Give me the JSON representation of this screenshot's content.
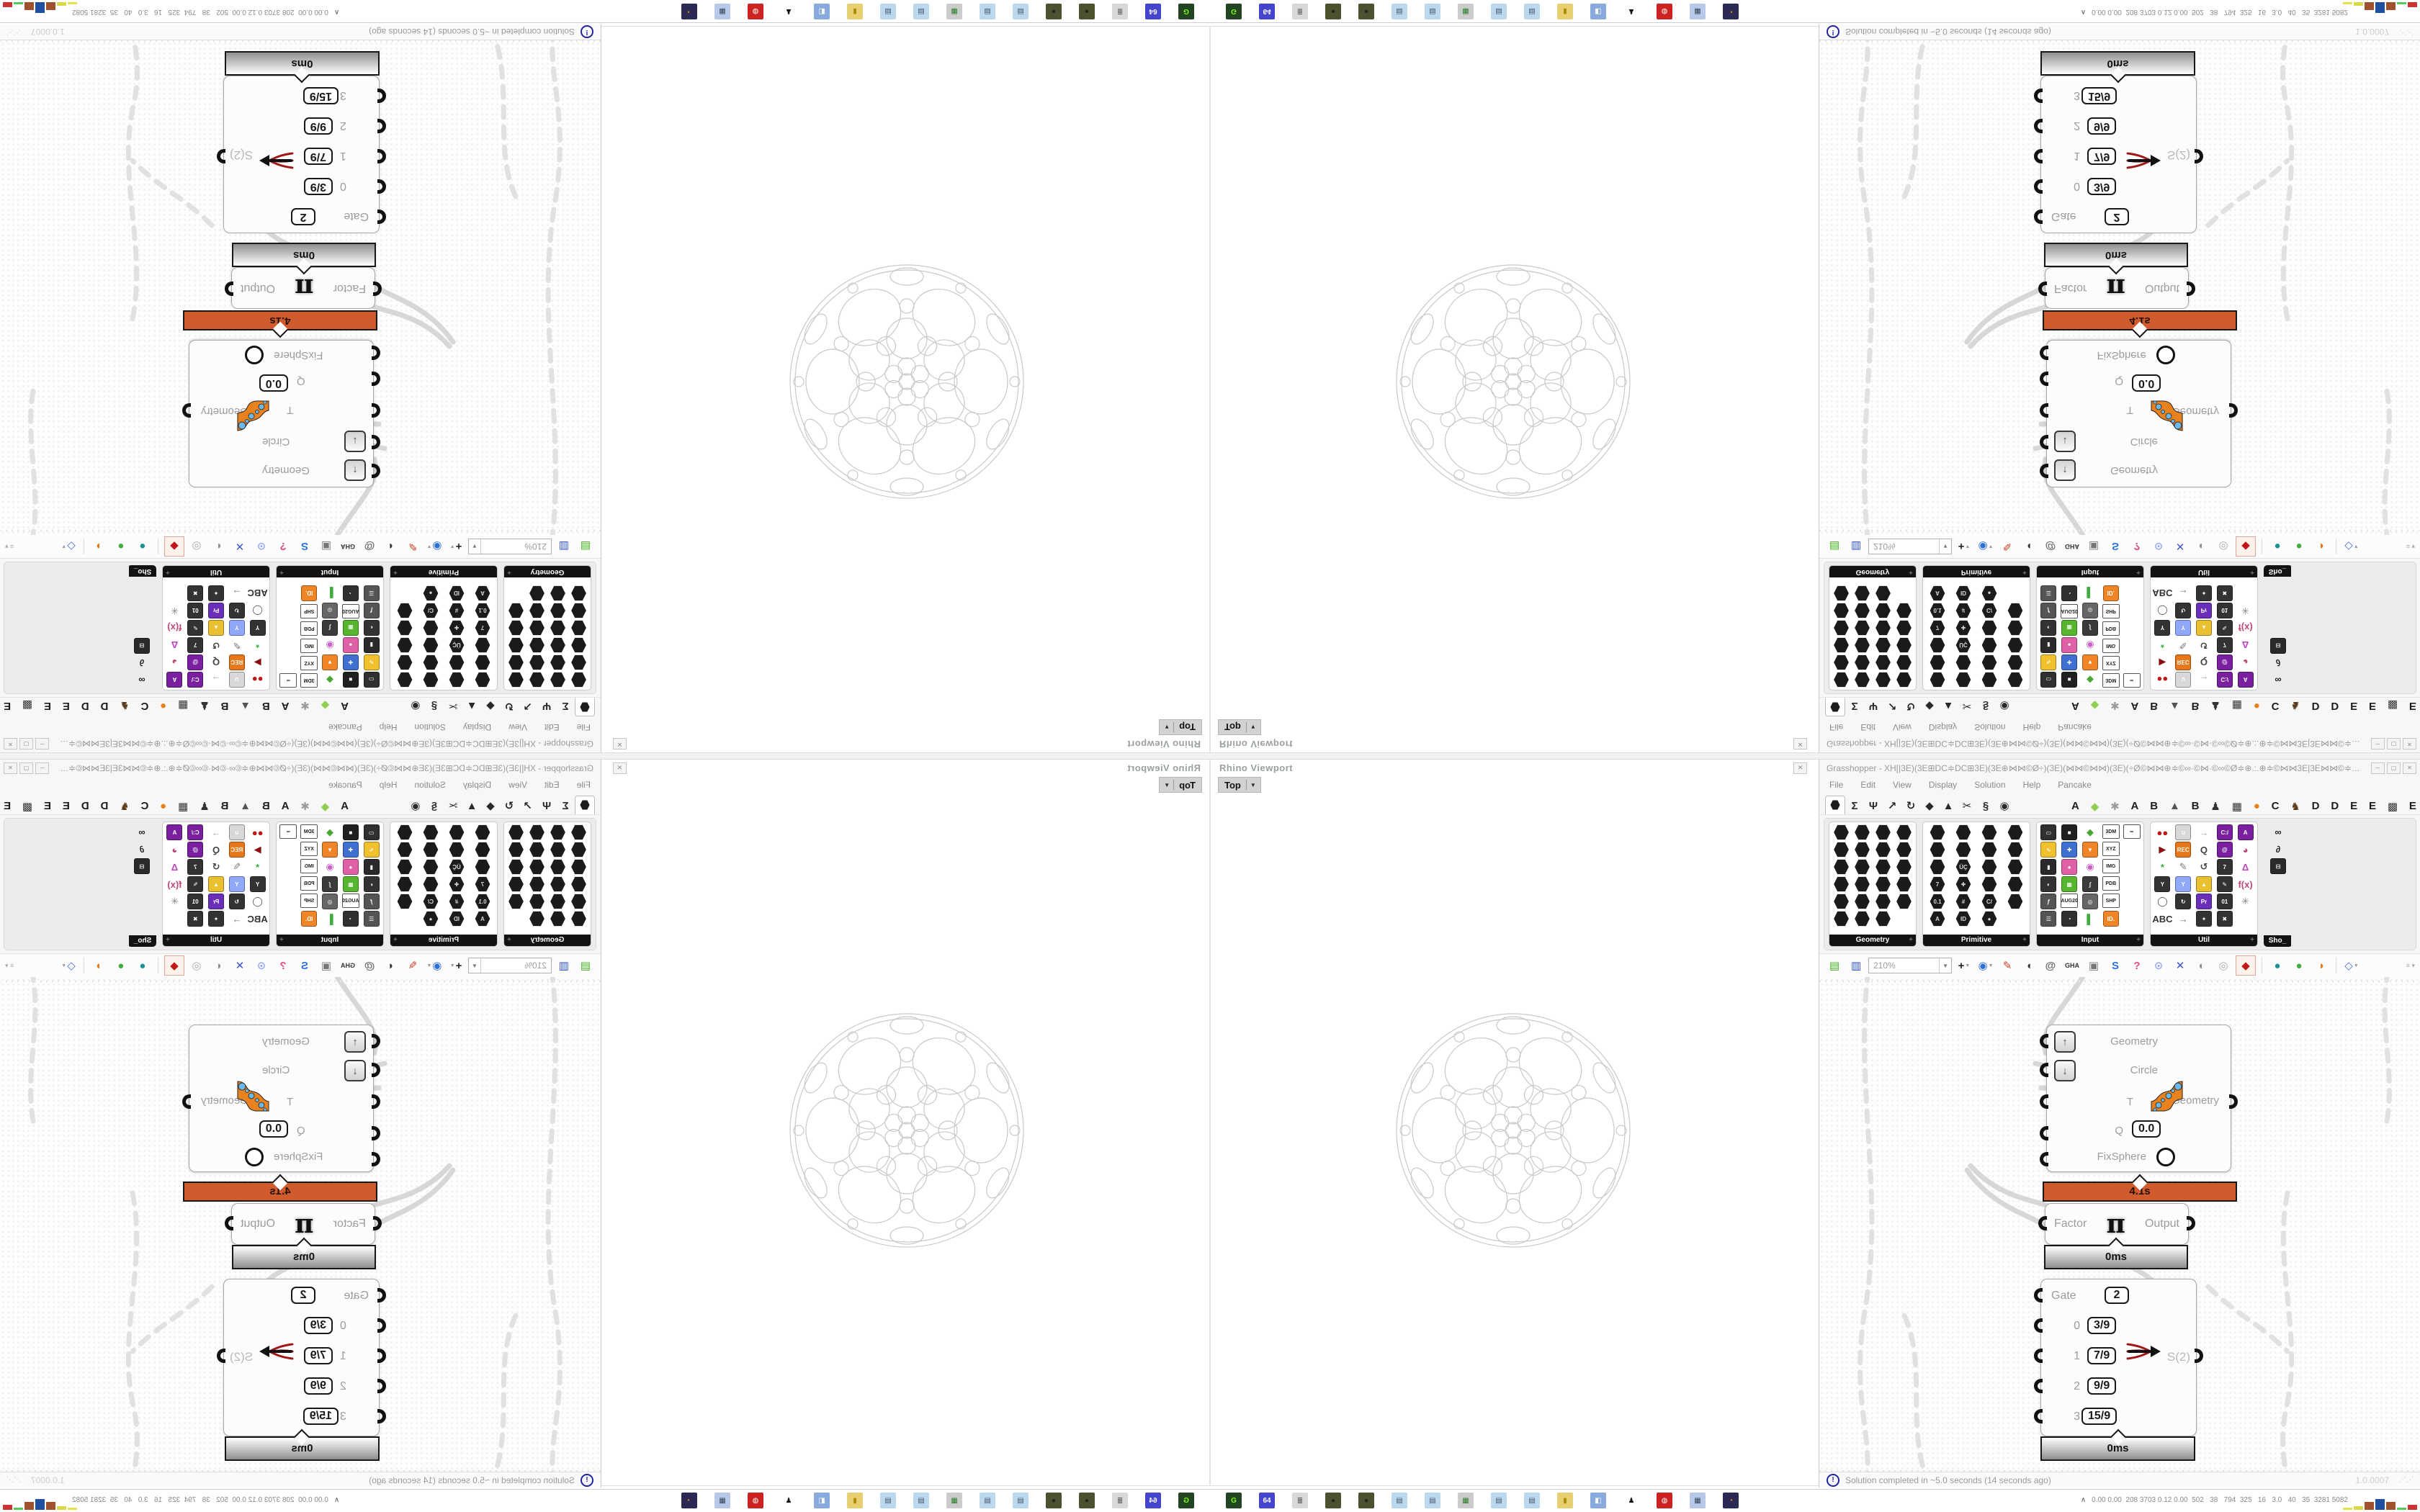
{
  "gh": {
    "title": "Grasshopper - XH[|3E)(3E⊞DC≑DC⊞3E)(3E⊕⋈⋈©Ø÷)(3E)(⋈⋈©⋈⋈)(3E)(÷Ø©⋈⋈⊕≑©∞·©⋈·©∞©Ø≑⊕.:.⊕≑©⋈⋈3E|3E⋈⋈©≑⊕.:.⊕≑©∞·©⋈·©∞©Ø≑⊕⋈⋈©Ø÷)(3E)(⋈⋈©⋈⋈©...",
    "window_buttons": [
      "─",
      "▢",
      "✕"
    ],
    "menu": [
      "File",
      "Edit",
      "View",
      "Display",
      "Solution",
      "Help",
      "Pancake"
    ]
  },
  "tabs": {
    "categories": [
      {
        "g": "hex",
        "sel": true
      },
      {
        "g": "Σ"
      },
      {
        "g": "Ψ"
      },
      {
        "g": "↗"
      },
      {
        "g": "↻"
      },
      {
        "g": "◆"
      },
      {
        "g": "▲"
      },
      {
        "g": "✂"
      },
      {
        "g": "§"
      },
      {
        "g": "◉"
      }
    ],
    "plugins": [
      {
        "g": "A",
        "c": "#1d1d1d"
      },
      {
        "g": "◆",
        "c": "#8fd14f"
      },
      {
        "g": "✱",
        "c": "#9a9a9a"
      },
      {
        "g": "A",
        "c": "#1d1d1d"
      },
      {
        "g": "B",
        "c": "#1d1d1d"
      },
      {
        "g": "▲",
        "c": "#555555"
      },
      {
        "g": "B",
        "c": "#1d1d1d"
      },
      {
        "g": "♟",
        "c": "#333333"
      },
      {
        "g": "▦",
        "c": "#333333"
      },
      {
        "g": "●",
        "c": "#e8821e"
      },
      {
        "g": "C",
        "c": "#1d1d1d"
      },
      {
        "g": "♞",
        "c": "#5a3a1a"
      },
      {
        "g": "D",
        "c": "#1d1d1d"
      },
      {
        "g": "D",
        "c": "#1d1d1d"
      },
      {
        "g": "E",
        "c": "#1d1d1d"
      },
      {
        "g": "E",
        "c": "#1d1d1d"
      },
      {
        "g": "▩",
        "c": "#333333"
      },
      {
        "g": "E",
        "c": "#1d1d1d"
      }
    ]
  },
  "palette": {
    "panels": [
      {
        "label": "Geometry",
        "cols": 4,
        "width": 120,
        "icons": [
          [
            "h"
          ],
          [
            "h"
          ],
          [
            "h"
          ],
          [
            "h"
          ],
          [
            "h"
          ],
          [
            "h"
          ],
          [
            "h"
          ],
          [
            "h"
          ],
          [
            "h"
          ],
          [
            "h"
          ],
          [
            "h"
          ],
          [
            "h"
          ],
          [
            "h"
          ],
          [
            "h"
          ],
          [
            "h"
          ],
          [
            "h"
          ],
          [
            "h"
          ],
          [
            "h"
          ],
          [
            "h"
          ],
          [
            "h"
          ],
          [
            "h"
          ],
          [
            "h"
          ],
          [
            "h"
          ]
        ]
      },
      {
        "label": "Primitive",
        "cols": 4,
        "width": 148,
        "icons": [
          [
            "h"
          ],
          [
            "h"
          ],
          [
            "h"
          ],
          [
            "h"
          ],
          [
            "h"
          ],
          [
            "h"
          ],
          [
            "h"
          ],
          [
            "h"
          ],
          [
            "h"
          ],
          [
            "h",
            "ÜÇ"
          ],
          [
            "h"
          ],
          [
            "h"
          ],
          [
            "h",
            "7"
          ],
          [
            "h",
            "✚"
          ],
          [
            "h"
          ],
          [
            "h"
          ],
          [
            "h",
            "0.1"
          ],
          [
            "h",
            "#"
          ],
          [
            "h",
            "C/"
          ],
          [
            "h"
          ],
          [
            "h",
            "A"
          ],
          [
            "h",
            "ID"
          ],
          [
            "h",
            "●"
          ]
        ]
      },
      {
        "label": "Input",
        "cols": 5,
        "width": 148,
        "icons": [
          [
            "s",
            "▭",
            "#303030"
          ],
          [
            "s",
            "■",
            "#202020"
          ],
          [
            "g",
            "◆",
            "#4aa832"
          ],
          [
            "c",
            "3DM"
          ],
          [
            "c",
            "∞"
          ],
          [
            "s",
            "∿",
            "#f2c12e"
          ],
          [
            "s",
            "✚",
            "#3f6fd0"
          ],
          [
            "s",
            "▼",
            "#f08528"
          ],
          [
            "c",
            "XYZ"
          ],
          0,
          [
            "s",
            "▮",
            "#2a2a2a"
          ],
          [
            "s",
            "●",
            "#e060a8"
          ],
          [
            "g",
            "◉",
            "#c860c8"
          ],
          [
            "c",
            "IMG"
          ],
          0,
          [
            "s",
            "◐",
            "#333333"
          ],
          [
            "s",
            "▦",
            "#57b52e"
          ],
          [
            "s",
            "∫",
            "#3a3a3a"
          ],
          [
            "c",
            "PDB"
          ],
          0,
          [
            "s",
            "ƒ",
            "#555555"
          ],
          [
            "c",
            "AUG20"
          ],
          [
            "s",
            "◎",
            "#666666"
          ],
          [
            "c",
            "SHP"
          ],
          0,
          [
            "s",
            "☰",
            "#555555"
          ],
          [
            "s",
            "◔",
            "#303030"
          ],
          [
            "g",
            "▌",
            "#3fae3f"
          ],
          [
            "s",
            "ID.",
            "#f08528"
          ],
          0
        ]
      },
      {
        "label": "Util",
        "cols": 5,
        "width": 148,
        "icons": [
          [
            "g",
            "●●",
            "#c01818"
          ],
          [
            "s",
            "∪",
            "#d8d8d8"
          ],
          [
            "g",
            "→",
            "#aaaaaa"
          ],
          [
            "s",
            "C:/",
            "#7a1fa0"
          ],
          [
            "s",
            "A",
            "#7a1fa0"
          ],
          [
            "g",
            "▶",
            "#8a1010"
          ],
          [
            "s",
            "REC",
            "#e87818"
          ],
          [
            "g",
            "Q",
            "#444444"
          ],
          [
            "s",
            "@",
            "#7a1fa0"
          ],
          [
            "g",
            "◕",
            "#c04878"
          ],
          [
            "g",
            "*",
            "#3fae3f"
          ],
          [
            "g",
            "✎",
            "#777777"
          ],
          [
            "g",
            "↺",
            "#444444"
          ],
          [
            "s",
            "7",
            "#333333"
          ],
          [
            "g",
            "Δ",
            "#c040c0"
          ],
          [
            "s",
            "Y",
            "#333333"
          ],
          [
            "s",
            "Y",
            "#8fa8f8"
          ],
          [
            "s",
            "▲",
            "#e8c030"
          ],
          [
            "s",
            "✎",
            "#333333"
          ],
          [
            "g",
            "f(x)",
            "#c04878"
          ],
          [
            "g",
            "◯",
            "#555555"
          ],
          [
            "s",
            "↻",
            "#333333"
          ],
          [
            "s",
            "Pr",
            "#6a2fb8"
          ],
          [
            "s",
            "01",
            "#333333"
          ],
          [
            "g",
            "✳",
            "#888888"
          ],
          [
            "g",
            "ABC",
            "#333333"
          ],
          [
            "g",
            "→",
            "#777777"
          ],
          [
            "s",
            "✦",
            "#333333"
          ],
          [
            "s",
            "✖",
            "#333333"
          ],
          0
        ]
      }
    ],
    "sho": {
      "label": "Sho_",
      "icons": [
        [
          "g",
          "∞",
          "#222222"
        ],
        [
          "g",
          "∂",
          "#222222"
        ],
        [
          "s",
          "⊟",
          "#2a2a2a"
        ]
      ]
    }
  },
  "toolbar": {
    "zoom": "210%",
    "buttons": [
      {
        "n": "open-file",
        "g": "▤",
        "c": "#3db014"
      },
      {
        "n": "save-file",
        "g": "▥",
        "c": "#2d50c8"
      },
      {
        "n": "zoom-select",
        "select": true
      },
      {
        "n": "zoom-extents",
        "g": "+",
        "c": "#222222",
        "dd": true
      },
      {
        "n": "preview-eye",
        "g": "◉",
        "c": "#2d6fd8",
        "dd": true
      },
      {
        "n": "sketch-pen",
        "g": "✎",
        "c": "#c83c1e"
      },
      {
        "n": "gumball",
        "g": "◖",
        "c": "#333333"
      },
      {
        "n": "cluster-at",
        "g": "@",
        "c": "#666666"
      },
      {
        "n": "gha-loader",
        "g": "GHA",
        "c": "#333333"
      },
      {
        "n": "window-view",
        "g": "▣",
        "c": "#777777"
      },
      {
        "n": "find-component",
        "g": "S",
        "c": "#2d6fd8"
      },
      {
        "n": "help-box",
        "g": "?",
        "c": "#e04880"
      },
      {
        "n": "hint-bulb",
        "g": "⊙",
        "c": "#97a8f0"
      },
      {
        "n": "wire-display",
        "g": "✕",
        "c": "#3a56c4"
      },
      {
        "n": "preview-off",
        "g": "◐",
        "c": "#909090"
      },
      {
        "n": "preview-wireframe",
        "g": "◎",
        "c": "#aaaaaa"
      },
      {
        "n": "preview-shaded",
        "g": "◆",
        "c": "#c01818",
        "hl": true
      },
      {
        "sep": true
      },
      {
        "n": "material-teal",
        "g": "●",
        "c": "#1f8f8f"
      },
      {
        "n": "material-green",
        "g": "●",
        "c": "#3fae3f"
      },
      {
        "n": "material-orange",
        "g": "◑",
        "c": "#e07818"
      },
      {
        "sep": true
      },
      {
        "n": "material-custom",
        "g": "◇",
        "c": "#4f6fd8",
        "dd": true
      }
    ]
  },
  "nodes": {
    "params_node": {
      "row1": "Geometry",
      "row2": "Circle",
      "row3": "T",
      "row4": "Q",
      "row4_value": "0.0",
      "row5": "FixSphere",
      "output": "Geometry",
      "time": "4.1s",
      "up_glyph": "↑",
      "down_glyph": "↓"
    },
    "pi_node": {
      "input": "Factor",
      "glyph": "π",
      "output": "Output",
      "time": "0ms"
    },
    "gate_node": {
      "r1_label": "Gate",
      "r1_value": "2",
      "r2_label": "0",
      "r2_value": "3/9",
      "r3_label": "1",
      "r3_value": "7/9",
      "r4_label": "2",
      "r4_value": "9/9",
      "r5_label": "3",
      "r5_value": "15/9",
      "output": "S(2)",
      "time": "0ms"
    }
  },
  "status": {
    "text": "Solution completed in ~5.0 seconds (14 seconds ago)",
    "version": "1.0.0007",
    "icon": "!"
  },
  "viewport": {
    "title": "Rhino Viewport",
    "tab": "Top",
    "tab_arrow": "▼",
    "close": "✕"
  },
  "taskbar": {
    "icons": [
      {
        "n": "meter-app",
        "g": "G",
        "c": "#224422",
        "fg": "#7CFC00"
      },
      {
        "n": "floppy64-app",
        "g": "64",
        "c": "#4444cc",
        "fg": "#ffffff"
      },
      {
        "n": "scroll-app",
        "g": "≣",
        "c": "#d8d8d8",
        "fg": "#555555"
      },
      {
        "n": "orb-app",
        "g": "●",
        "c": "#4a5230",
        "fg": "#222222"
      },
      {
        "n": "orb-app",
        "g": "●",
        "c": "#4a5230",
        "fg": "#222222"
      },
      {
        "n": "notepad-app",
        "g": "▤",
        "c": "#bcd8ee",
        "fg": "#445566"
      },
      {
        "n": "notepad-app",
        "g": "▤",
        "c": "#bcd8ee",
        "fg": "#445566"
      },
      {
        "n": "monitor-app",
        "g": "▦",
        "c": "#cccccc",
        "fg": "#2a7a2a"
      },
      {
        "n": "notepad-app",
        "g": "▤",
        "c": "#bcd8ee",
        "fg": "#445566"
      },
      {
        "n": "notepad-app",
        "g": "▤",
        "c": "#bcd8ee",
        "fg": "#445566"
      },
      {
        "n": "folder-app",
        "g": "▮",
        "c": "#e8d070",
        "fg": "#aa8800"
      },
      {
        "n": "plug-app",
        "g": "◧",
        "c": "#88aadd",
        "fg": "#ffffff"
      },
      {
        "n": "penguin-app",
        "g": "♟",
        "c": "#ffffff",
        "fg": "#111111"
      },
      {
        "n": "metro-app",
        "g": "◍",
        "c": "#cc2222",
        "fg": "#ffffff"
      },
      {
        "n": "calculator-app",
        "g": "▦",
        "c": "#b8c8e8",
        "fg": "#334455"
      },
      {
        "n": "firefox-app",
        "g": "◔",
        "c": "#2a2a55",
        "fg": "#ff8c1a"
      }
    ],
    "monitor_prefix": "∧",
    "stats": "0.00 0.00  208 3703 0.12 0.00  502   38   794  325   16   3.0   40   35  3281 5082",
    "bars": [
      {
        "c": "#e8e24a",
        "h": 3
      },
      {
        "c": "#d8d84a",
        "h": 5
      },
      {
        "c": "#a0522d",
        "h": 11
      },
      {
        "c": "#1f4fa0",
        "h": 15
      },
      {
        "c": "#a0522d",
        "h": 11
      },
      {
        "c": "#55cc55",
        "h": 3
      },
      {
        "c": "#cc3333",
        "h": 7
      }
    ]
  }
}
